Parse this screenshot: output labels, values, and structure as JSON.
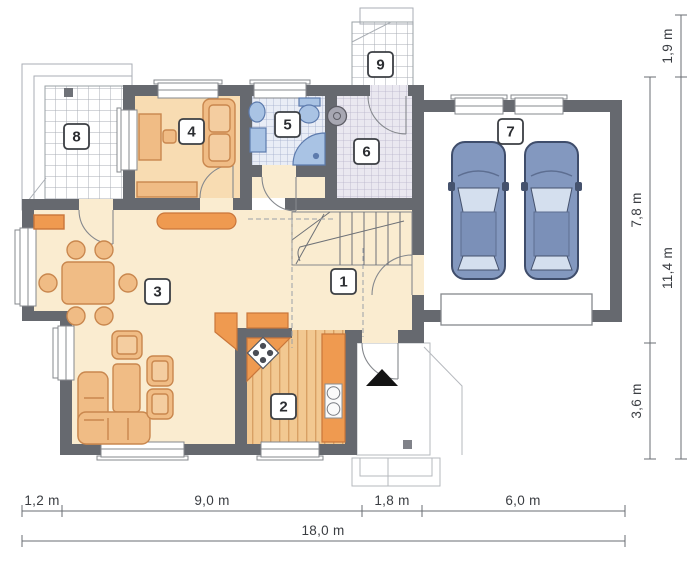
{
  "plan": {
    "type": "house-floor-plan",
    "rooms": [
      {
        "number": "1"
      },
      {
        "number": "2"
      },
      {
        "number": "3"
      },
      {
        "number": "4"
      },
      {
        "number": "5"
      },
      {
        "number": "6"
      },
      {
        "number": "7"
      },
      {
        "number": "8"
      },
      {
        "number": "9"
      }
    ],
    "dimensions": {
      "bottom_segments": [
        "1,2 m",
        "9,0 m",
        "1,8 m",
        "6,0 m"
      ],
      "bottom_total": "18,0 m",
      "right_segments": [
        "1,9 m",
        "7,8 m",
        "3,6 m"
      ],
      "right_total": "11,4 m"
    },
    "colors": {
      "wall": "#66696f",
      "floor_cream": "#faecd0",
      "room4_floor": "#f8dcb2",
      "kitchen_wood": "#f2c891",
      "furniture": "#f0bc85",
      "accent_orange": "#ef9a50",
      "bath_fixture": "#a9c3e4",
      "car_body": "#8398bf",
      "dimension_text": "#3a3d42"
    }
  }
}
